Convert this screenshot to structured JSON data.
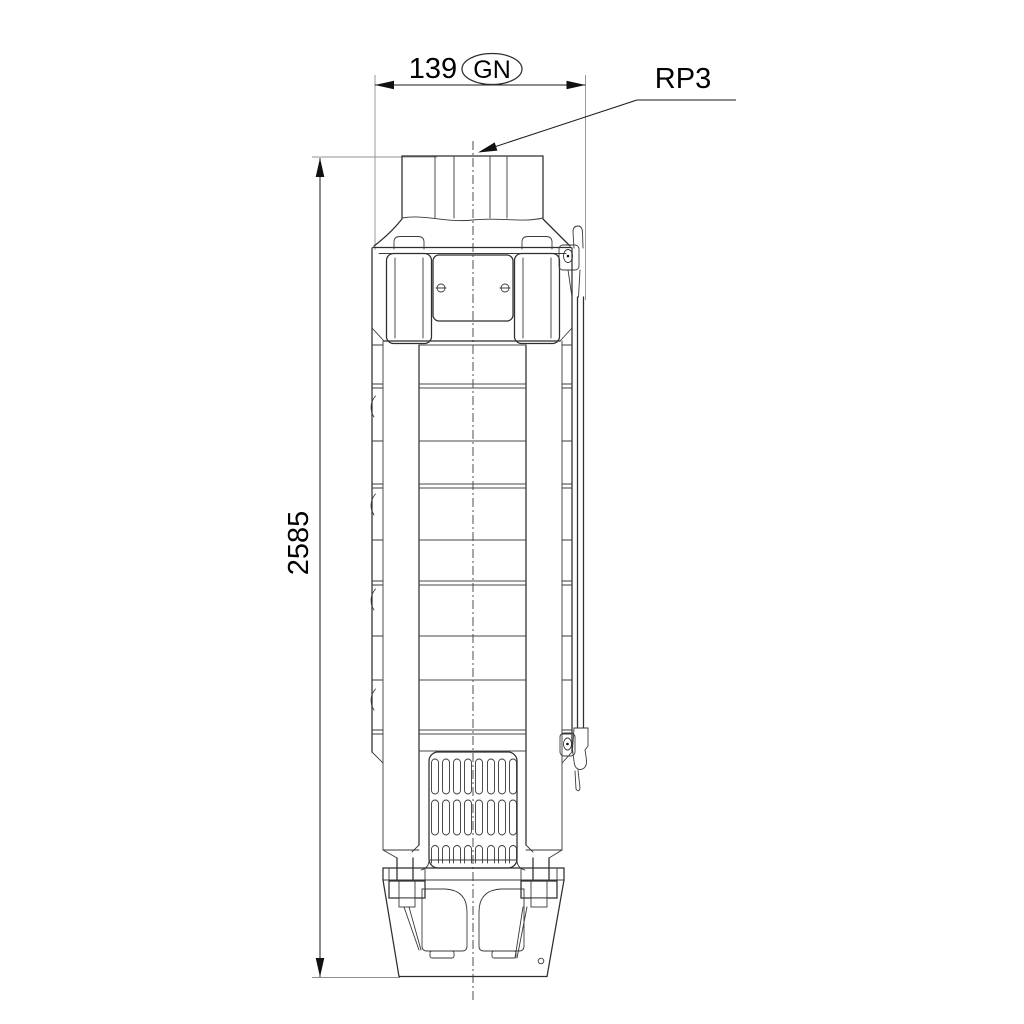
{
  "drawing": {
    "subject": "submersible-pump-dimensional-outline",
    "background": "#ffffff",
    "line_color": "#2e2e2e",
    "dimension_color": "#1a1a1a",
    "extension_color": "#909090",
    "text_color": "#000000",
    "dimensions": {
      "width": {
        "value": "139",
        "badge": "GN"
      },
      "height": {
        "value": "2585"
      },
      "connection_thread": {
        "label": "RP3"
      }
    }
  }
}
